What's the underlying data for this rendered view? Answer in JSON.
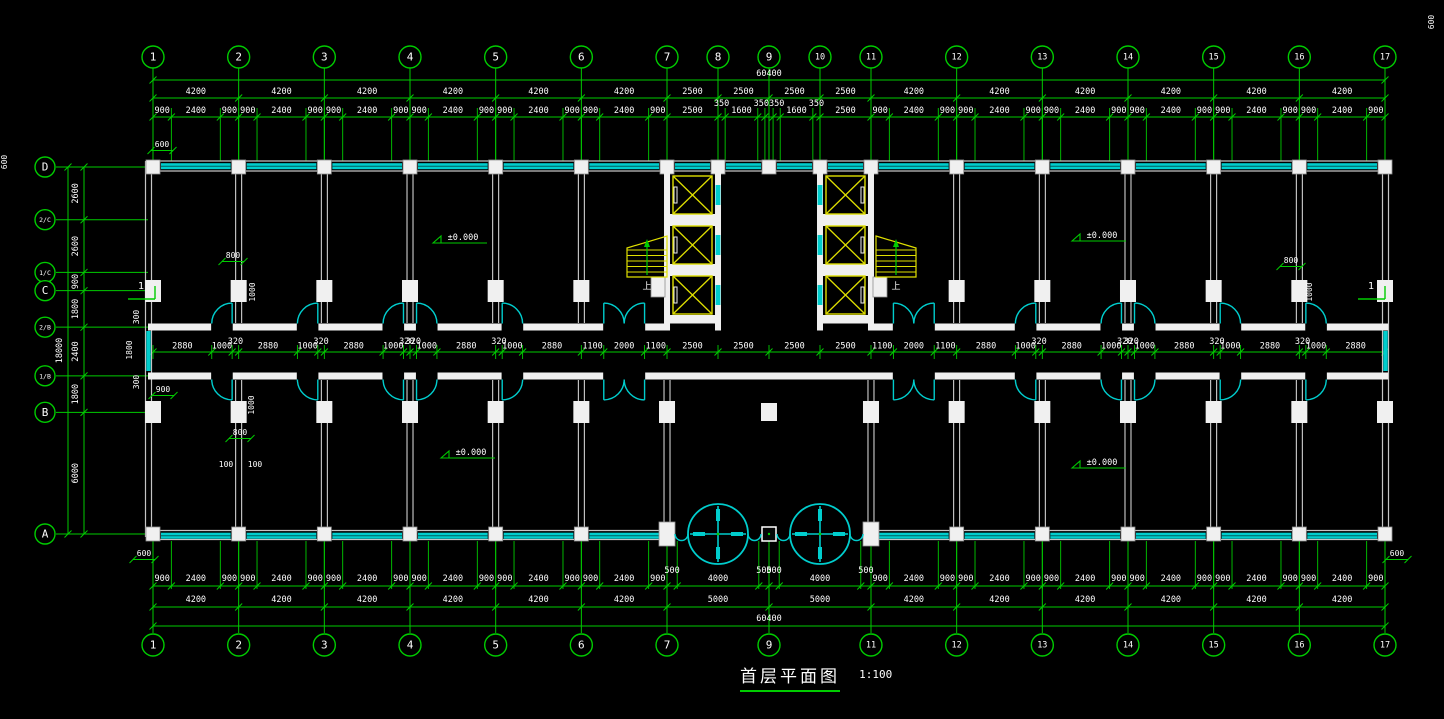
{
  "title": {
    "text": "首层平面图",
    "scale": "1:100"
  },
  "colors": {
    "background": "#000000",
    "grid_green": "#00CC00",
    "dim_text": "#FFFFFF",
    "wall_white": "#F0F0F0",
    "wall_gray": "#C4C4C4",
    "window_cyan": "#00CDCD",
    "fixture_yellow": "#DFDF00"
  },
  "axes": {
    "col_labels": [
      "1",
      "2",
      "3",
      "4",
      "5",
      "6",
      "7",
      "8",
      "9",
      "10",
      "11",
      "12",
      "13",
      "14",
      "15",
      "16",
      "17"
    ],
    "bottom_col_labels": [
      "1",
      "2",
      "3",
      "4",
      "5",
      "6",
      "7",
      "9",
      "11",
      "12",
      "13",
      "14",
      "15",
      "16",
      "17"
    ],
    "row_labels": [
      "D",
      "2/C",
      "1/C",
      "C",
      "2/B",
      "1/B",
      "B",
      "A"
    ]
  },
  "dims": {
    "overall_h": "60400",
    "overall_v": "18000",
    "top_bays": [
      4200,
      4200,
      4200,
      4200,
      4200,
      4200,
      2500,
      2500,
      2500,
      2500,
      4200,
      4200,
      4200,
      4200,
      4200,
      4200
    ],
    "top_detail": [
      900,
      2400,
      900,
      900,
      2400,
      900,
      900,
      2400,
      900,
      900,
      2400,
      900,
      900,
      2400,
      900,
      900,
      2400,
      900,
      2500,
      350,
      1600,
      350,
      {
        "w": 400,
        "t": ""
      },
      350,
      1600,
      350,
      2500,
      900,
      2400,
      900,
      900,
      2400,
      900,
      900,
      2400,
      900,
      900,
      2400,
      900,
      900,
      2400,
      900,
      900,
      2400,
      900
    ],
    "bottom_bays": [
      4200,
      4200,
      4200,
      4200,
      4200,
      4200,
      5000,
      5000,
      4200,
      4200,
      4200,
      4200,
      4200,
      4200
    ],
    "bottom_detail": [
      900,
      2400,
      900,
      900,
      2400,
      900,
      900,
      2400,
      900,
      900,
      2400,
      900,
      900,
      2400,
      900,
      900,
      2400,
      900,
      500,
      4000,
      500,
      500,
      4000,
      500,
      900,
      2400,
      900,
      900,
      2400,
      900,
      900,
      2400,
      900,
      900,
      2400,
      900,
      900,
      2400,
      900,
      900,
      2400,
      900
    ],
    "left_detail": [
      2600,
      2600,
      900,
      1800,
      2400,
      1800,
      6000
    ],
    "corridor": [
      2880,
      1000,
      320,
      2880,
      1000,
      320,
      2880,
      1000,
      320,
      320,
      1000,
      2880,
      320,
      1000,
      2880,
      1100,
      2000,
      1100,
      2500,
      2500,
      2500,
      2500,
      1100,
      2000,
      1100,
      2880,
      1000,
      320,
      2880,
      1000,
      320,
      320,
      1000,
      2880,
      320,
      1000,
      2880,
      320,
      1000,
      2880
    ],
    "local": [
      {
        "t": "800",
        "x": 233,
        "y": 258,
        "u": 1
      },
      {
        "t": "1000",
        "x": 255,
        "y": 292,
        "r": 1
      },
      {
        "t": "1000",
        "x": 254,
        "y": 405,
        "r": 1
      },
      {
        "t": "800",
        "x": 240,
        "y": 435,
        "u": 1
      },
      {
        "t": "100",
        "x": 226,
        "y": 467
      },
      {
        "t": "100",
        "x": 255,
        "y": 467
      },
      {
        "t": "800",
        "x": 1291,
        "y": 263,
        "u": 1
      },
      {
        "t": "1000",
        "x": 1312,
        "y": 292,
        "r": 1
      },
      {
        "t": "300",
        "x": 139,
        "y": 317,
        "r": 1
      },
      {
        "t": "1800",
        "x": 132,
        "y": 350,
        "r": 1
      },
      {
        "t": "300",
        "x": 139,
        "y": 382,
        "r": 1
      },
      {
        "t": "900",
        "x": 163,
        "y": 392,
        "u": 1
      },
      {
        "t": "600",
        "x": 162,
        "y": 147,
        "u": 1
      },
      {
        "t": "600",
        "x": 144,
        "y": 556,
        "u": 1
      },
      {
        "t": "600",
        "x": 1397,
        "y": 556,
        "u": 1
      },
      {
        "t": "600",
        "x": 1434,
        "y": 22,
        "r": 1
      },
      {
        "t": "600",
        "x": 7,
        "y": 162,
        "r": 1
      }
    ]
  },
  "doors": [
    {
      "mm": 2880,
      "w": 1000,
      "h": "R"
    },
    {
      "mm": 7080,
      "w": 1000,
      "h": "R"
    },
    {
      "mm": 11280,
      "w": 1000,
      "h": "R"
    },
    {
      "mm": 12920,
      "w": 1000,
      "h": "L"
    },
    {
      "mm": 17120,
      "w": 1000,
      "h": "L"
    },
    {
      "mm": 22100,
      "w": 2000,
      "h": "C"
    },
    {
      "mm": 36300,
      "w": 2000,
      "h": "C"
    },
    {
      "mm": 42280,
      "w": 1000,
      "h": "R"
    },
    {
      "mm": 46480,
      "w": 1000,
      "h": "R"
    },
    {
      "mm": 48120,
      "w": 1000,
      "h": "L"
    },
    {
      "mm": 52320,
      "w": 1000,
      "h": "L"
    },
    {
      "mm": 56520,
      "w": 1000,
      "h": "L"
    }
  ],
  "annotations": {
    "level_label": "±0.000",
    "level_points": [
      {
        "x": 447,
        "y": 236
      },
      {
        "x": 1086,
        "y": 234
      },
      {
        "x": 455,
        "y": 451
      },
      {
        "x": 1086,
        "y": 461
      }
    ],
    "stair_label": "上",
    "stair_points": [
      {
        "x": 647,
        "y": 289
      },
      {
        "x": 896,
        "y": 289
      }
    ],
    "section_label": "1",
    "section_points": [
      {
        "x": 141,
        "y": 289
      },
      {
        "x": 1371,
        "y": 289
      }
    ]
  }
}
